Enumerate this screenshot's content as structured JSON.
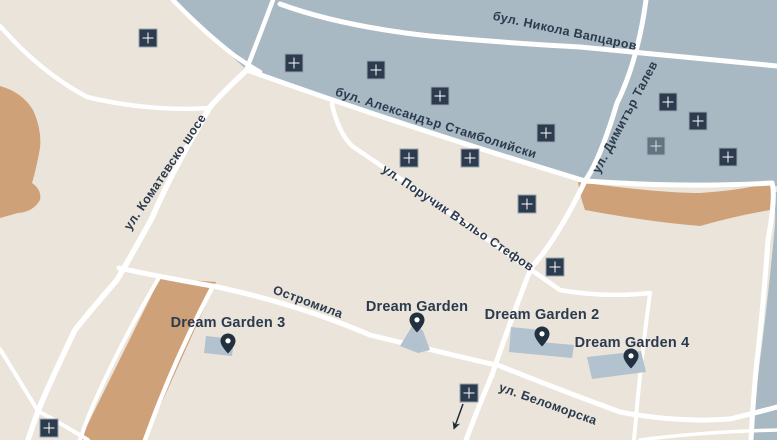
{
  "map": {
    "streets": [
      {
        "id": "vaptsarov",
        "label": "бул. Никола Вапцаров"
      },
      {
        "id": "stamboliyski",
        "label": "бул. Александър Стамболийски"
      },
      {
        "id": "stefov",
        "label": "ул. Поручик Въльо Стефов"
      },
      {
        "id": "talev",
        "label": "ул. Димитър Талев"
      },
      {
        "id": "komatevsko",
        "label": "ул. Коматевско шосе"
      },
      {
        "id": "ostromila",
        "label": "Остромила"
      },
      {
        "id": "belomorska",
        "label": "ул. Беломорска"
      }
    ],
    "places": [
      {
        "id": "dg1",
        "label": "Dream Garden"
      },
      {
        "id": "dg2",
        "label": "Dream Garden 2"
      },
      {
        "id": "dg3",
        "label": "Dream Garden 3"
      },
      {
        "id": "dg4",
        "label": "Dream Garden 4"
      }
    ],
    "markers": [
      {
        "x": 148,
        "y": 38
      },
      {
        "x": 294,
        "y": 63
      },
      {
        "x": 376,
        "y": 70
      },
      {
        "x": 440,
        "y": 96
      },
      {
        "x": 546,
        "y": 133
      },
      {
        "x": 409,
        "y": 158
      },
      {
        "x": 470,
        "y": 158
      },
      {
        "x": 527,
        "y": 204
      },
      {
        "x": 668,
        "y": 102
      },
      {
        "x": 698,
        "y": 121
      },
      {
        "x": 656,
        "y": 146,
        "faded": true
      },
      {
        "x": 728,
        "y": 157
      },
      {
        "x": 555,
        "y": 267
      },
      {
        "x": 469,
        "y": 393
      },
      {
        "x": 49,
        "y": 428
      }
    ],
    "colors": {
      "background": "#eae4da",
      "district": "#a8b9c3",
      "field": "#cfa178",
      "road": "#ffffff",
      "label": "#2c3a4d",
      "marker": "#2c3b4e",
      "marker_border": "#98a4ae",
      "building": "#b2c2ce",
      "pin": "#22303f"
    }
  }
}
